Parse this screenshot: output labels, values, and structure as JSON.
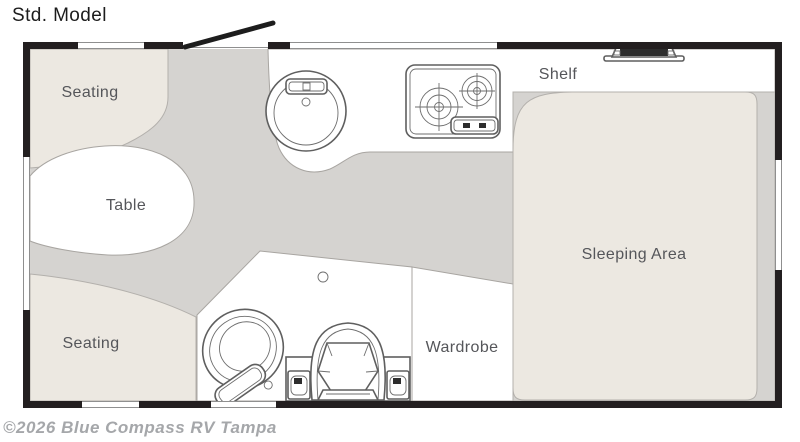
{
  "title": "Std. Model",
  "watermark": "©2026 Blue Compass RV Tampa",
  "floorplan": {
    "labels": {
      "seating_front": "Seating",
      "table": "Table",
      "seating_rear": "Seating",
      "shelf": "Shelf",
      "sleeping_area": "Sleeping Area",
      "wardrobe": "Wardrobe"
    },
    "fixtures": [
      "entry-door",
      "round-sink",
      "two-burner-cooktop",
      "roof-vent",
      "toilet",
      "captain-chair",
      "speaker-box",
      "ceiling-light"
    ],
    "colors": {
      "wall": "#231f20",
      "floor": "#d5d3d0",
      "upholstery": "#ece8e1",
      "counter": "#ffffff",
      "outline": "#8f8f8f",
      "label_text": "#55565a",
      "watermark_text": "#a5a7aa"
    }
  }
}
